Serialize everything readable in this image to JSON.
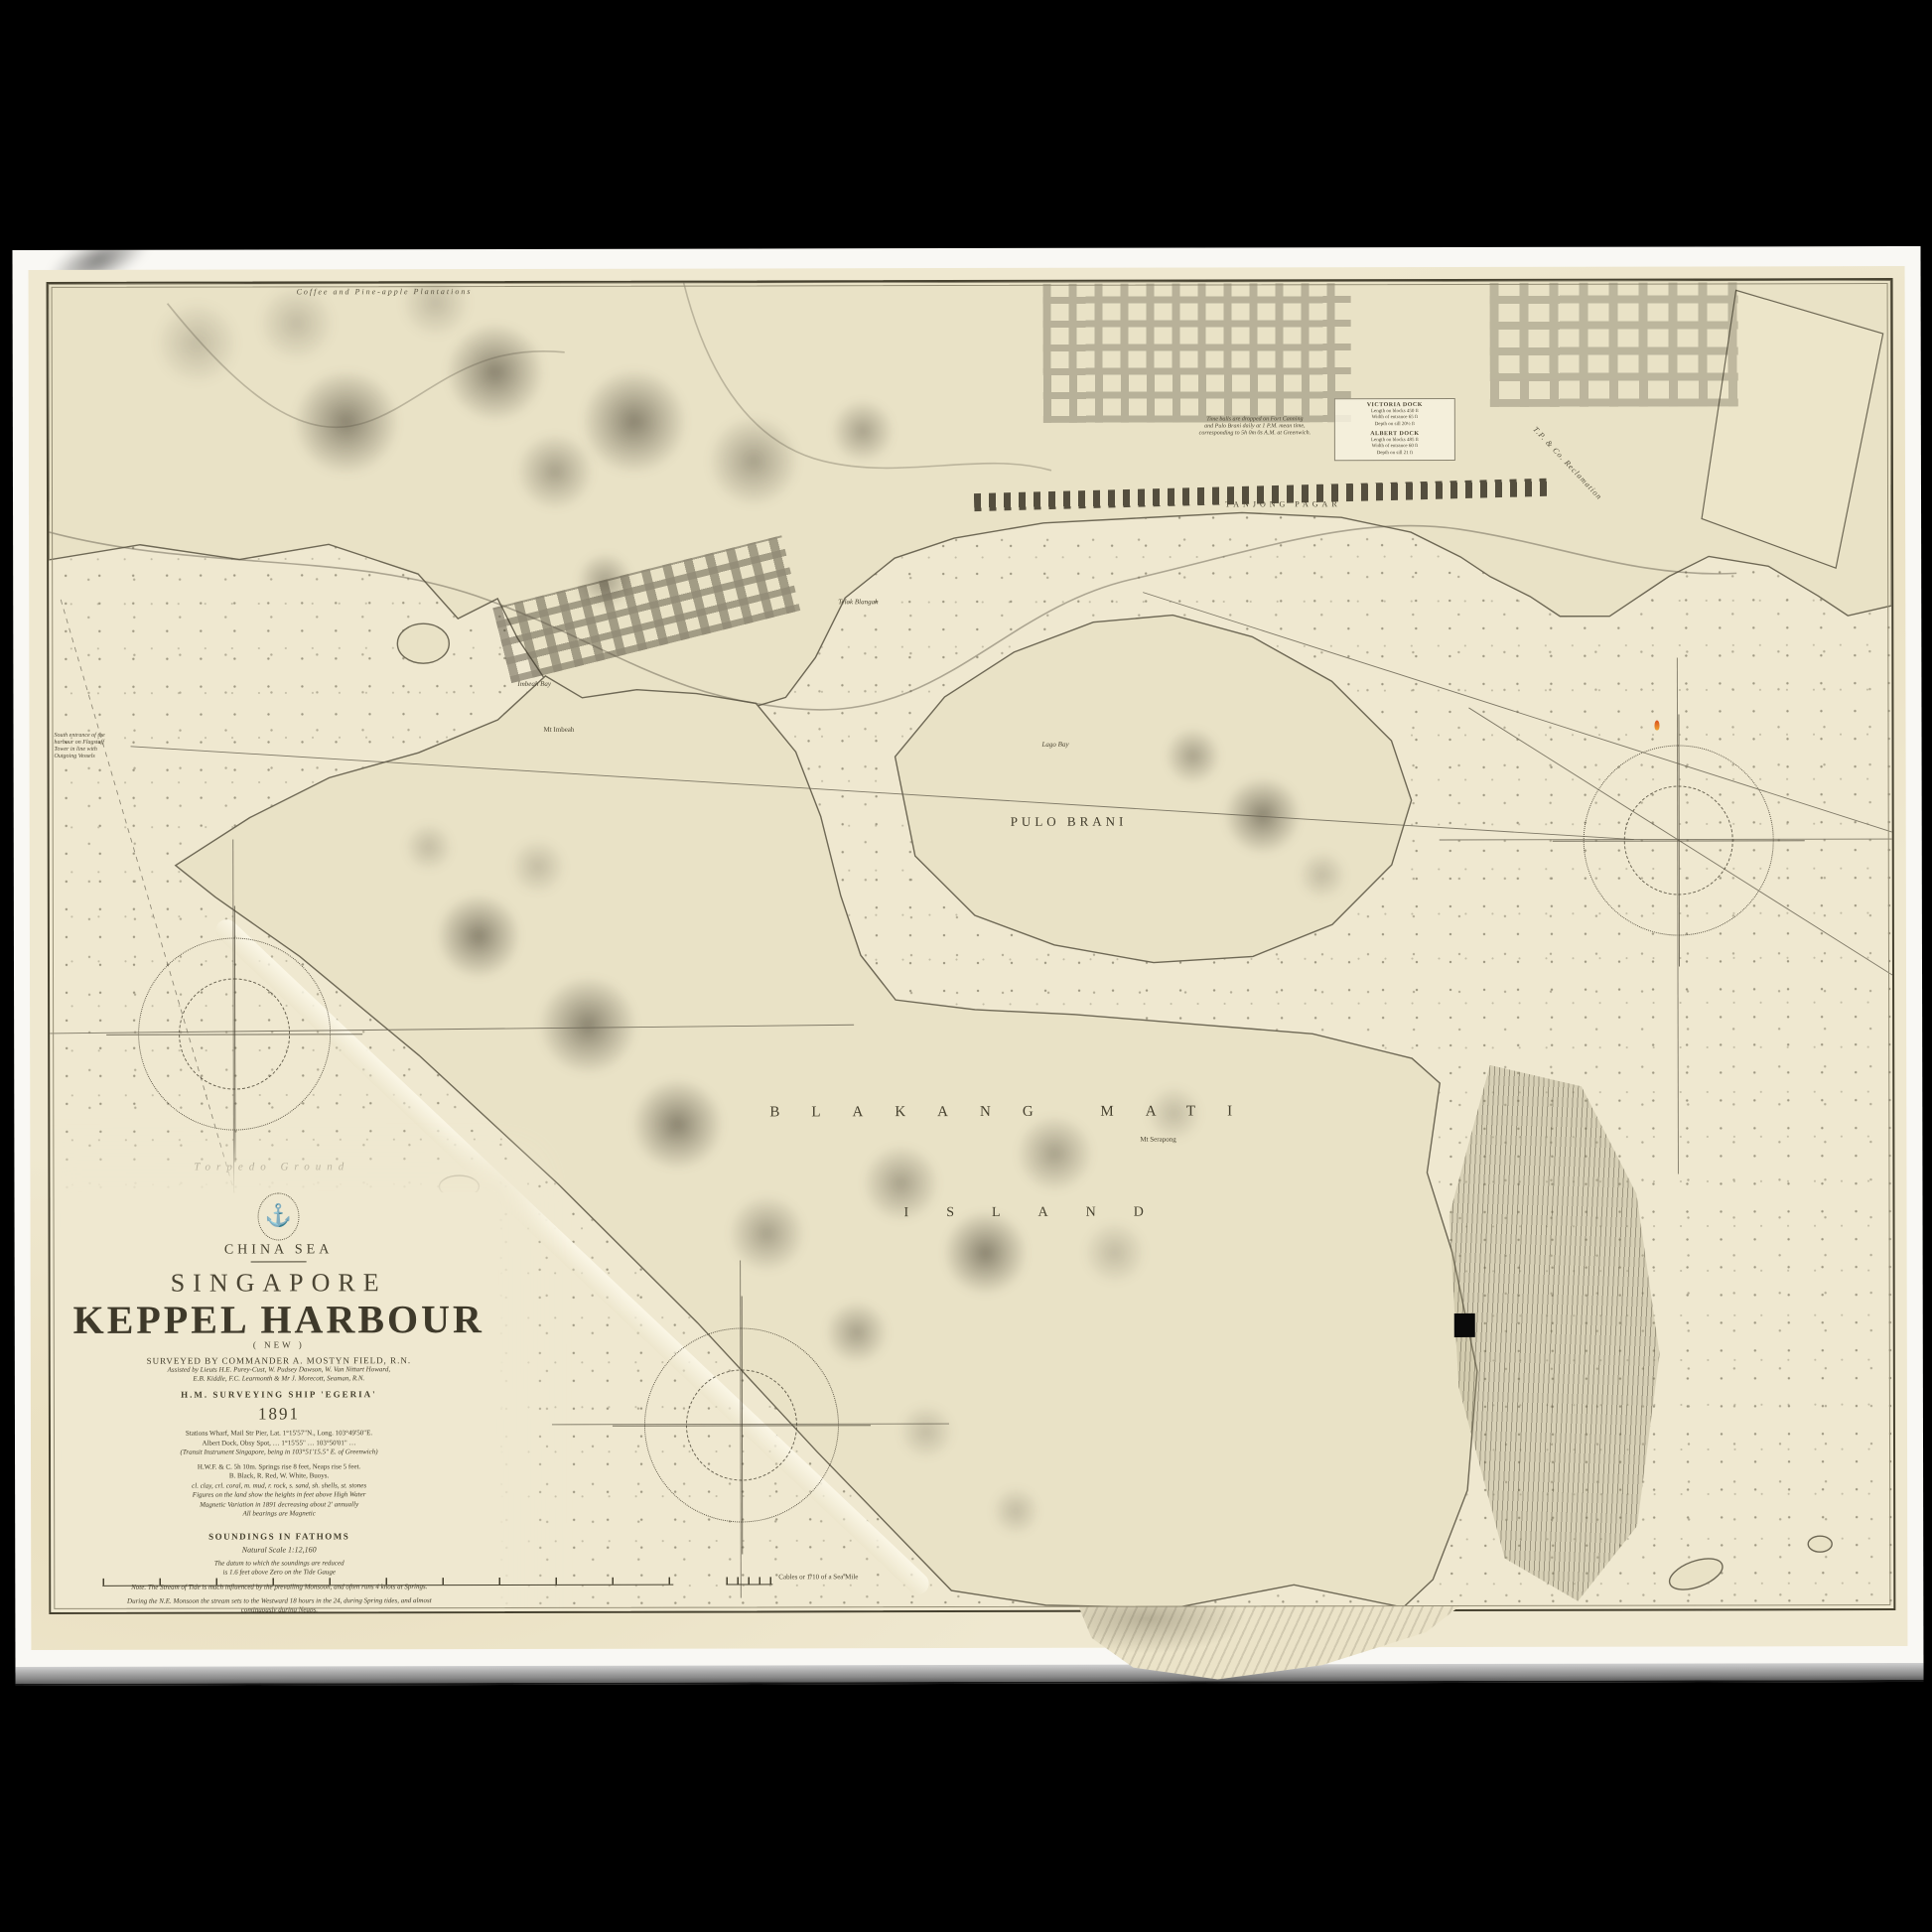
{
  "title_block": {
    "sea": "CHINA SEA",
    "place": "SINGAPORE",
    "title": "KEPPEL HARBOUR",
    "subtitle": "( NEW )",
    "surveyed": "SURVEYED BY COMMANDER A. MOSTYN FIELD, R.N.",
    "assisted1": "Assisted by Lieuts H.E. Purey-Cust, W. Pudsey Dawson, W. Van Nittart Howard,",
    "assisted2": "E.B. Kiddle, F.C. Learmonth & Mr J. Morecott, Seaman, R.N.",
    "ship": "H.M. SURVEYING SHIP 'EGERIA'",
    "year": "1891",
    "position1": "Stations Wharf, Mail Str Pier, Lat. 1°15'57\"N., Long. 103°49'50\"E.",
    "position2": "Albert Dock, Obsy Spot, … 1°15'55\" … 103°50'01\" …",
    "position3": "(Transit Instrument Singapore, being in 103°51'15.5\" E. of Greenwich)",
    "tides": "H.W.F. & C. 5h 10m. Springs rise 8 feet, Neaps rise 5 feet.",
    "buoys": "B. Black, R. Red, W. White, Buoys.",
    "abbreviations": "cl. clay, crl. coral, m. mud, r. rock, s. sand, sh. shells, st. stones",
    "heights": "Figures on the land show the heights in feet above High Water",
    "variation": "Magnetic Variation in 1891 decreasing about 2' annually",
    "bearings": "All bearings are Magnetic",
    "soundings": "SOUNDINGS IN FATHOMS",
    "natural_scale": "Natural Scale 1:12,160",
    "datum1": "The datum to which the soundings are reduced",
    "datum2": "is 1.6 feet above Zero on the Tide Gauge"
  },
  "notes": [
    "Note. The Stream of Tide is much influenced by the prevailing Monsoon, and often runs 4 knots at Springs.",
    "During the N.E. Monsoon the stream sets to the Westward 18 hours in the 24, during Spring tides, and almost continuously during Neaps.",
    "Too much reliance must not be placed upon the buoys, as they are occasionally disturbed by Junks being fastened to them. Strangers are recommended to take a Pilot.",
    "The tides are largely affected by diurnal inequality. The general sequence is one high and one low water, followed by a second high and low water of considerably less range, amounting at times to a few inches only."
  ],
  "labels": {
    "coffee": "Coffee and Pine-apple Plantations",
    "telok_blangah": "Telok Blangah",
    "tanjong_pagar": "TANJONG PAGAR",
    "reclamation": "T.P. & Co. Reclamation",
    "lago_bay": "Lago Bay",
    "pulo_brani": "PULO BRANI",
    "blakang_mati": "BLAKANG MATI",
    "island": "ISLAND",
    "mt_serapong": "Mt Serapong",
    "mt_imbeah": "Mt Imbeah",
    "imbeah_bay": "Imbeah Bay",
    "torpedo_ground": "Torpedo Ground",
    "cables": "Cables or 1/10 of a Sea Mile"
  },
  "timeball_note": [
    "Time balls are dropped on Fort Canning",
    "and Pulo Brani daily at 1 P.M. mean time,",
    "corresponding to 5h 0m 0s A.M. at Greenwich."
  ],
  "south_note": [
    "South entrance of the",
    "harbour on Flagstaff",
    "Tower in line with",
    "Outgoing Vessels"
  ],
  "dock_box": {
    "victoria_title": "VICTORIA DOCK",
    "v1": "Length on blocks 450 ft",
    "v2": "Width of entrance 65 ft",
    "v3": "Depth on sill 20½ ft",
    "albert_title": "ALBERT DOCK",
    "a1": "Length on blocks 485 ft",
    "a2": "Width of entrance 60 ft",
    "a3": "Depth on sill 21 ft"
  },
  "icons": {
    "seal": "⚓"
  },
  "colors": {
    "paper": "#efe8d0",
    "land": "#e9e2c6",
    "ink": "#46412f",
    "letterbox": "#000000",
    "buoy_light": "#f0a22e"
  }
}
